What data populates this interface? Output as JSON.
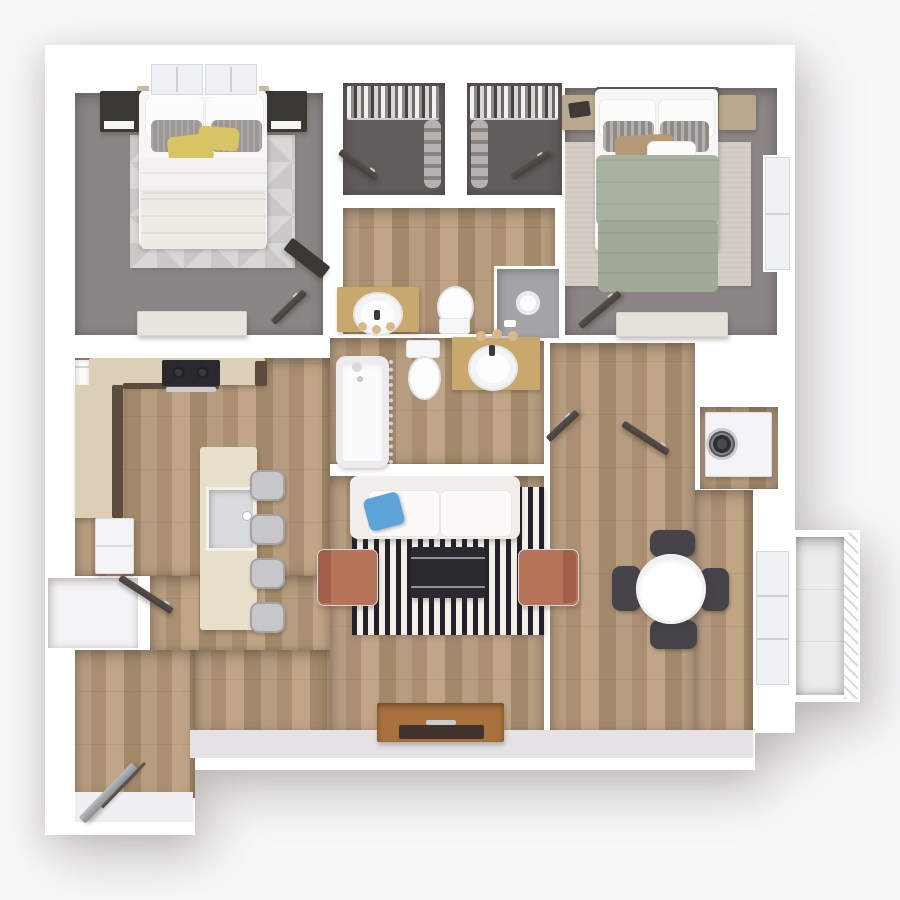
{
  "scene": {
    "title": "Two-bedroom, two-bathroom apartment 3D floor plan",
    "view": "top-down 3D architectural render, no text labels",
    "rooms": [
      {
        "id": "bedroom-1",
        "label": "Bedroom 1",
        "floor": "gray carpet",
        "furniture": [
          "bed with white duvet",
          "gray pillows",
          "yellow accent pillows",
          "two dark nightstands",
          "geometric area rug",
          "dresser",
          "dark desk",
          "two windows"
        ]
      },
      {
        "id": "walk-in-closet-1",
        "label": "Walk-in Closet 1",
        "floor": "dark carpet",
        "furniture": [
          "hanging clothes rod",
          "stacked shelf bins",
          "open door"
        ]
      },
      {
        "id": "walk-in-closet-2",
        "label": "Walk-in Closet 2",
        "floor": "dark carpet",
        "furniture": [
          "hanging clothes rod",
          "stacked shelf bins",
          "open door"
        ]
      },
      {
        "id": "bathroom-1",
        "label": "Bathroom 1",
        "floor": "wood plank",
        "furniture": [
          "wood vanity with round sink",
          "toilet",
          "walk-in shower with glass door"
        ]
      },
      {
        "id": "bedroom-2",
        "label": "Bedroom 2",
        "floor": "gray carpet",
        "furniture": [
          "bed with sage green duvet",
          "striped gray pillows",
          "tan lumbar pillow",
          "two light wood nightstands",
          "beige area rug",
          "dresser",
          "window"
        ]
      },
      {
        "id": "bathroom-2",
        "label": "Bathroom 2",
        "floor": "wood plank",
        "furniture": [
          "bathtub with curtain",
          "toilet",
          "wood vanity with round sink",
          "sconce lights"
        ]
      },
      {
        "id": "kitchen",
        "label": "Kitchen",
        "floor": "wood plank",
        "furniture": [
          "L-shaped counter",
          "black cooktop",
          "refrigerator",
          "island with sink",
          "four gray bar stools",
          "pantry closet"
        ]
      },
      {
        "id": "living-room",
        "label": "Living Room",
        "floor": "wood plank",
        "furniture": [
          "white sofa",
          "blue throw pillow",
          "black and white striped rug",
          "dark coffee table",
          "two terracotta armchairs",
          "wood media console"
        ]
      },
      {
        "id": "dining-area",
        "label": "Dining Area",
        "floor": "wood plank",
        "furniture": [
          "round white table",
          "four dark chairs",
          "sliding glass door"
        ]
      },
      {
        "id": "laundry-closet",
        "label": "Laundry Closet",
        "floor": "wood plank",
        "furniture": [
          "front-load washer dryer unit"
        ]
      },
      {
        "id": "entry",
        "label": "Entry",
        "floor": "wood plank",
        "furniture": [
          "open entry door",
          "threshold"
        ]
      },
      {
        "id": "balcony",
        "label": "Balcony",
        "floor": "light tile",
        "furniture": [
          "slatted railing"
        ]
      }
    ]
  },
  "palette": {
    "bg": "#f7f7f8",
    "wall": "#ffffff",
    "wallshade": "#e4e2e5",
    "wood-a": "#b79d80",
    "wood-b": "#aa8f72",
    "wood-c": "#c0a586",
    "wood-d": "#a28969",
    "carpet": "#8b8685",
    "closet-carpet": "#615d5c",
    "rug-light": "#dad8d6",
    "rug-beige": "#d0cac1",
    "stripe-dark": "#24212a",
    "stripe-light": "#f3f0ea",
    "sage": "#a9b2a1",
    "sage-dark": "#a1aa99",
    "yellow": "#d8c465",
    "blue": "#5ea3d8",
    "terracotta": "#b5735a",
    "terracotta-dark": "#a2604a",
    "door-dark": "#46403c",
    "dark-furn": "#3b3733",
    "light-wood": "#dbcfb8",
    "dark-cab": "#5b4c3f",
    "island-wood": "#e8dfcb",
    "vanity-wood": "#c9a86d",
    "console-wood": "#a9713d",
    "tray-dark": "#41332b",
    "white-furn": "#f7f6f4",
    "steel": "#c9cdd1",
    "charcoal": "#2b2930",
    "tile": "#ededee",
    "glass": "#eef2f5",
    "stool": "#c7c7ca",
    "chair-dark": "#46444a",
    "shower-gray": "#a4a4a6",
    "tan-bulb": "#d9b98c",
    "appliance": "#f4f4f6"
  }
}
